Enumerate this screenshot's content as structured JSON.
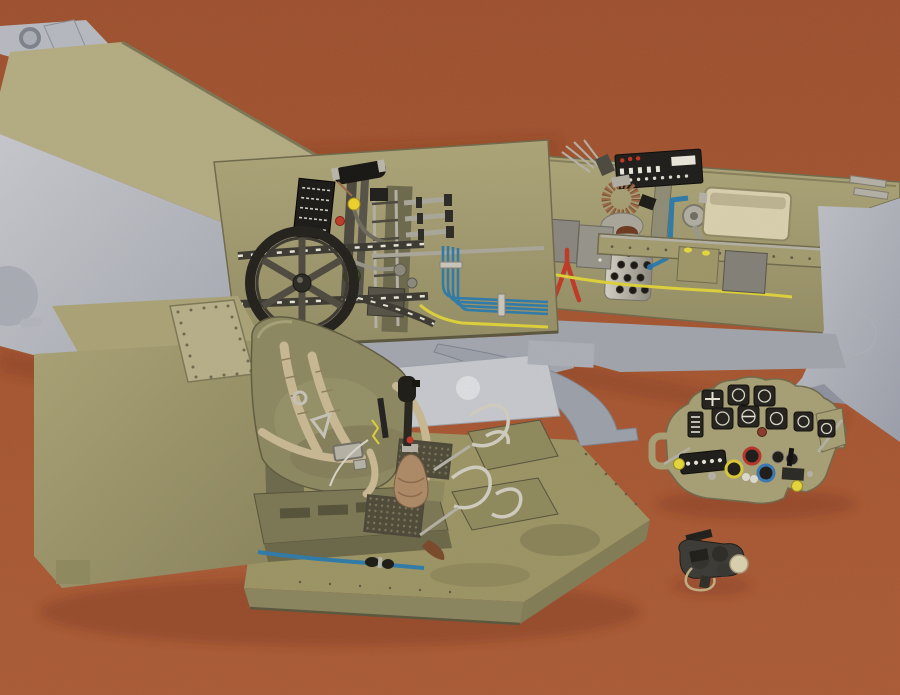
{
  "image": {
    "title": "Scale-model fighter cockpit set photographed on carpet",
    "alt": "Unassembled 1/32 scale cockpit model parts: two fuselage halves with detailed khaki sidewalls, a cockpit floor with seat and harness, a separate instrument panel and a small gunsight, laid on a rust-orange carpet"
  },
  "palette": {
    "carpet": "#a5522f",
    "carpet_light": "#b05c38",
    "carpet_dark": "#94492a",
    "plastic_gray": "#b7bbc3",
    "plastic_gray_shadow": "#99a0aa",
    "khaki": "#a49e72",
    "khaki_light": "#b4ae84",
    "khaki_dark": "#84805c",
    "olive_dark": "#6c6a4e",
    "seat_olive": "#8c8962",
    "harness_tan": "#c8b995",
    "black_part": "#23221e",
    "silver": "#b3b1aa",
    "wire_blue": "#2e7cab",
    "wire_yellow": "#ddd23c",
    "accent_red": "#c03a28",
    "copper": "#9a6a48",
    "cream": "#d8d1b0"
  },
  "objects": {
    "carpet": {
      "label": "Rust-orange carpet background"
    },
    "left_fuselage": {
      "label": "Left fuselage half, light gray plastic"
    },
    "left_sidewall": {
      "label": "Left cockpit sidewall with trim wheel, throttle quadrant and wiring"
    },
    "trim_wheel": {
      "label": "Black elevator trim wheel with chain runs"
    },
    "throttle_quadrant": {
      "label": "Throttle quadrant with yellow and red knobs and data placard"
    },
    "right_fuselage": {
      "label": "Right fuselage half, light gray plastic"
    },
    "right_sidewall": {
      "label": "Right cockpit sidewall with electrical panel, bottle and map case"
    },
    "perforated_bottle": {
      "label": "Perforated silver bottle with primer pump and copper coil"
    },
    "map_case": {
      "label": "Cream map case tray"
    },
    "cockpit_tub": {
      "label": "Cockpit floor section with forward tank cover"
    },
    "pilot_seat": {
      "label": "Pilot seat with tan harness straps and buckles"
    },
    "control_stick": {
      "label": "Control stick with leather boot"
    },
    "rudder_pedals": {
      "label": "Rudder pedals with stirrup loops"
    },
    "instrument_panel": {
      "label": "Arched instrument panel with black gauges and colored bezels"
    },
    "gunsight": {
      "label": "Small black gunsight part with cream knob"
    }
  }
}
